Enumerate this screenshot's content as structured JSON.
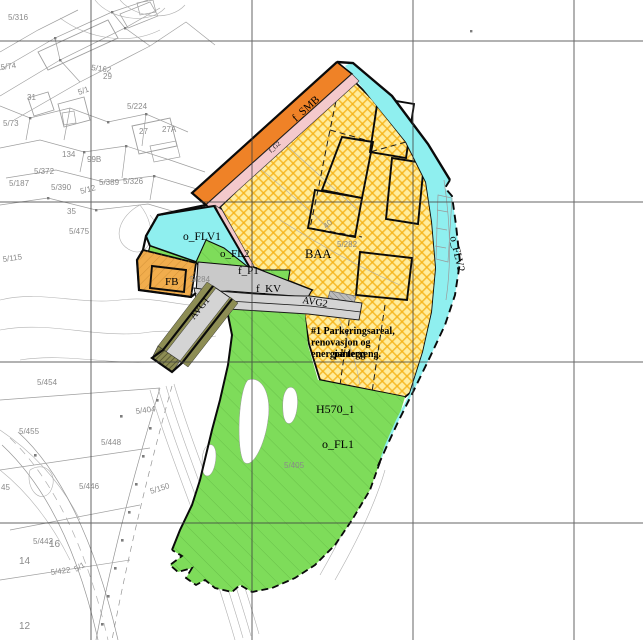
{
  "map": {
    "title": "Reguleringsplan utsnitt",
    "colors": {
      "orange": "#EF8227",
      "pink": "#F4C9CC",
      "cyan": "#8FEFEF",
      "yellow_base": "#FFED9E",
      "yellow_stripe": "#F5B114",
      "green": "#7EDC5A",
      "green_hatch": "#55A83B",
      "road_gray": "#D4D4D4",
      "p1_gray": "#C9C9C9",
      "olive": "#8D8D54",
      "fb_orange": "#F1AD4D",
      "fb_hatch": "#C9882F",
      "grid": "#3F3F3F",
      "base_line": "#9A9A9A",
      "base_text": "#8a8a8a",
      "boundary": "#0A0A0A"
    },
    "grid": {
      "vertical_x": [
        91,
        252,
        413,
        574
      ],
      "horizontal_y": [
        41,
        202,
        362,
        523
      ]
    },
    "zone_labels": [
      {
        "t": "f_SMB",
        "x": 296,
        "y": 122,
        "rot": -42,
        "size": 11
      },
      {
        "t": "f_G2",
        "x": 271,
        "y": 153,
        "rot": -42,
        "size": 6.5
      },
      {
        "t": "o_FLV1",
        "x": 183,
        "y": 240,
        "rot": 0,
        "size": 11.5
      },
      {
        "t": "o_FL2",
        "x": 220,
        "y": 257,
        "rot": 0,
        "size": 11
      },
      {
        "t": "f_P1",
        "x": 238,
        "y": 274,
        "rot": 0,
        "size": 11
      },
      {
        "t": "FB",
        "x": 165,
        "y": 285,
        "rot": 0,
        "size": 11
      },
      {
        "t": "f_KV",
        "x": 256,
        "y": 292,
        "rot": 0,
        "size": 11
      },
      {
        "t": "AVG2",
        "x": 302,
        "y": 303,
        "rot": 9,
        "size": 10
      },
      {
        "t": "AVG1",
        "x": 194,
        "y": 320,
        "rot": -51,
        "size": 10
      },
      {
        "t": "BAA",
        "x": 305,
        "y": 258,
        "rot": 0,
        "size": 12.5
      },
      {
        "t": "o_FLV2",
        "x": 450,
        "y": 237,
        "rot": 77,
        "size": 11
      },
      {
        "t": "H570_1",
        "x": 316,
        "y": 413,
        "rot": 0,
        "size": 12
      },
      {
        "t": "o_FL1",
        "x": 322,
        "y": 448,
        "rot": 0,
        "size": 12
      }
    ],
    "note": {
      "lines": [
        "#1 Parkeringsareal,",
        "renovasjon og",
        "energianlegg"
      ],
      "x": 311,
      "y": 334,
      "line_height": 11.5,
      "size": 10,
      "overlay_line": {
        "t": "på terreng.",
        "x": 334,
        "y": 357
      }
    },
    "cadastral_labels": [
      {
        "t": "5/316",
        "x": 8,
        "y": 20
      },
      {
        "t": "5/74",
        "x": 1,
        "y": 70,
        "rot": -8
      },
      {
        "t": "5/162",
        "x": 91,
        "y": 70,
        "rot": 8
      },
      {
        "t": "29",
        "x": 103,
        "y": 79
      },
      {
        "t": "5/1",
        "x": 79,
        "y": 95,
        "rot": -20
      },
      {
        "t": "31",
        "x": 27,
        "y": 100
      },
      {
        "t": "5/224",
        "x": 127,
        "y": 109
      },
      {
        "t": "5/73",
        "x": 3,
        "y": 126
      },
      {
        "t": "27",
        "x": 139,
        "y": 134
      },
      {
        "t": "27A",
        "x": 162,
        "y": 132
      },
      {
        "t": "134",
        "x": 62,
        "y": 157
      },
      {
        "t": "99B",
        "x": 87,
        "y": 162
      },
      {
        "t": "5/372",
        "x": 34,
        "y": 174
      },
      {
        "t": "5/187",
        "x": 9,
        "y": 186
      },
      {
        "t": "5/390",
        "x": 51,
        "y": 190
      },
      {
        "t": "5/12",
        "x": 81,
        "y": 194,
        "rot": -15
      },
      {
        "t": "5/389",
        "x": 99,
        "y": 185
      },
      {
        "t": "5/326",
        "x": 123,
        "y": 184
      },
      {
        "t": "35",
        "x": 67,
        "y": 214
      },
      {
        "t": "5/475",
        "x": 69,
        "y": 234
      },
      {
        "t": "5/115",
        "x": 3,
        "y": 262,
        "rot": -8
      },
      {
        "t": "5/284",
        "x": 190,
        "y": 282
      },
      {
        "t": "5/282",
        "x": 337,
        "y": 247
      },
      {
        "t": "40",
        "x": 326,
        "y": 229,
        "rot": -40
      },
      {
        "t": "5/454",
        "x": 37,
        "y": 385
      },
      {
        "t": "5/404",
        "x": 136,
        "y": 414,
        "rot": -8
      },
      {
        "t": "5/455",
        "x": 19,
        "y": 434
      },
      {
        "t": "5/448",
        "x": 101,
        "y": 445
      },
      {
        "t": "45",
        "x": 1,
        "y": 490
      },
      {
        "t": "5/446",
        "x": 79,
        "y": 489
      },
      {
        "t": "5/150",
        "x": 151,
        "y": 494,
        "rot": -18
      },
      {
        "t": "5/442",
        "x": 33,
        "y": 544
      },
      {
        "t": "16",
        "x": 49,
        "y": 547,
        "size": 10
      },
      {
        "t": "14",
        "x": 19,
        "y": 564,
        "size": 10
      },
      {
        "t": "5/422",
        "x": 51,
        "y": 575,
        "rot": -8
      },
      {
        "t": "5/1",
        "x": 76,
        "y": 572,
        "rot": -30
      },
      {
        "t": "12",
        "x": 19,
        "y": 629,
        "size": 10
      },
      {
        "t": "5/405",
        "x": 284,
        "y": 468
      }
    ]
  }
}
